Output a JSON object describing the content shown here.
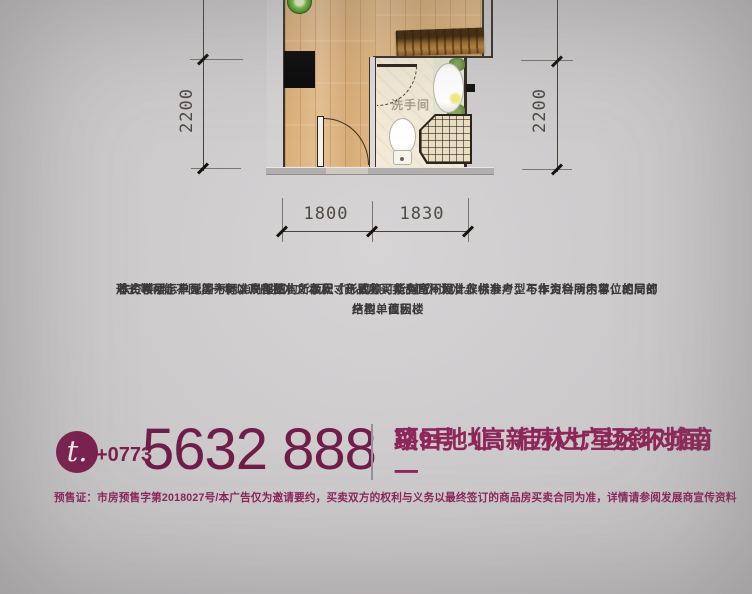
{
  "floorplan": {
    "bathroom_label": "洗手间",
    "dim_left": "2200",
    "dim_right": "2200",
    "dim_bottom_left": "1800",
    "dim_bottom_right": "1830"
  },
  "disclaimer": {
    "lines": [
      "本资料所示户型图为标准户型图，所示尺寸、面积、所列空间设计仅供参考，不作为合同内容，相同的户型单位因楼",
      "栋、楼层、单元等不同，局部结构、面积、形式等可能有所不同，非标准户型与本资料所示单位的局部结构、面积、",
      "形式等可能不同，一切以政府批准文本及《商品房买卖合同》为准。"
    ]
  },
  "contact": {
    "phone_icon_label": "t.",
    "area_code": "+0773",
    "phone_number": "5632 888",
    "address_line1": "项目地址：桂林七星区环城南一",
    "address_line2": "路9号（高新万达广场斜对面）"
  },
  "legal_notice": "预售证：市房预售字第2018027号/本广告仅为邀请要约，买卖双方的权利与义务以最终签订的商品房买卖合同为准，详情请参阅发展商宣传资料",
  "colors": {
    "accent_maroon": "#7b1f4e",
    "address_maroon": "#8e2759",
    "background_gray": "#cbc9ca"
  }
}
